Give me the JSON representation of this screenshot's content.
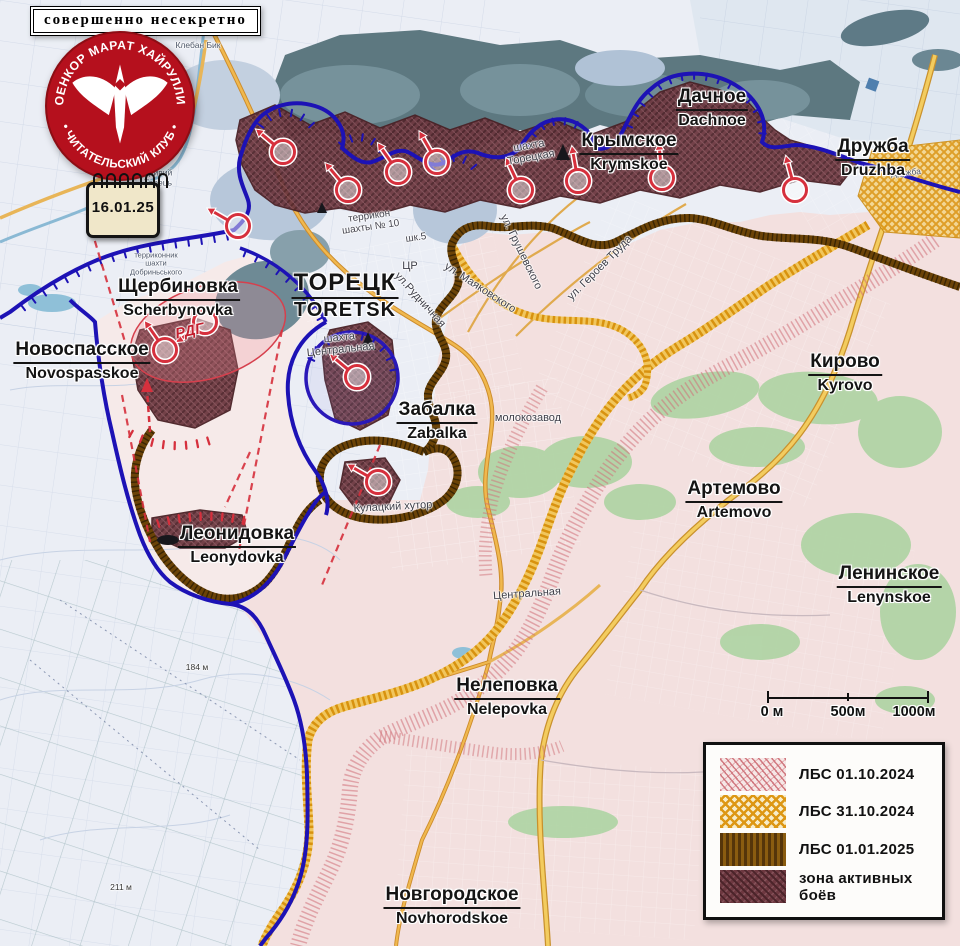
{
  "banner": {
    "text": "совершенно несекретно"
  },
  "logo": {
    "arc_top": "ВОЕНКОР МАРАТ ХАЙРУЛЛИН",
    "arc_bottom": "• ЧИТАТЕЛЬСКИЙ КЛУБ •"
  },
  "calendar": {
    "date": "16.01.25"
  },
  "places": [
    {
      "id": "shcherbynovka",
      "ru": "Щербиновка",
      "en": "Scherbynovka"
    },
    {
      "id": "novospasskoe",
      "ru": "Новоспасское",
      "en": "Novospasskoe"
    },
    {
      "id": "toretsk",
      "ru": "ТОРЕЦК",
      "en": "TORETSK"
    },
    {
      "id": "dachnoe",
      "ru": "Дачное",
      "en": "Dachnoe"
    },
    {
      "id": "krymskoe",
      "ru": "Крымское",
      "en": "Krymskoe"
    },
    {
      "id": "druzhba",
      "ru": "Дружба",
      "en": "Druzhba"
    },
    {
      "id": "zabalka",
      "ru": "Забалка",
      "en": "Zabalka"
    },
    {
      "id": "kyrovo",
      "ru": "Кирово",
      "en": "Kyrovo"
    },
    {
      "id": "artemovo",
      "ru": "Артемово",
      "en": "Artemovo"
    },
    {
      "id": "lenynskoe",
      "ru": "Ленинское",
      "en": "Lenynskoe"
    },
    {
      "id": "leonydovka",
      "ru": "Леонидовка",
      "en": "Leonydovka"
    },
    {
      "id": "nelepovka",
      "ru": "Нелеповка",
      "en": "Nelepovka"
    },
    {
      "id": "novhorodskoe",
      "ru": "Новгородское",
      "en": "Novhorodskoe"
    }
  ],
  "map_labels": [
    {
      "id": "shakhta-toretskaya",
      "text": "шахта\nТорецкая"
    },
    {
      "id": "terrikon-shakhty-10",
      "text": "террикон\nшахты № 10"
    },
    {
      "id": "shk-5",
      "text": "шк.5"
    },
    {
      "id": "tsr",
      "text": "ЦР"
    },
    {
      "id": "ul-rudnichnaya",
      "text": "ул.Рудничная"
    },
    {
      "id": "ul-mayakovskogo",
      "text": "ул. Маяковского"
    },
    {
      "id": "ul-grushevskogo",
      "text": "ул. Грушевского"
    },
    {
      "id": "ul-geroev-truda",
      "text": "ул. Героев Труда"
    },
    {
      "id": "molokozavod",
      "text": "молокозавод"
    },
    {
      "id": "tsentralnaya-street",
      "text": "Центральная"
    },
    {
      "id": "shakhta-tsentralnaya",
      "text": "шахта\nЦентральная"
    },
    {
      "id": "kulatsky-khutor",
      "text": "Кулацкий хутор"
    },
    {
      "id": "rdg",
      "text": "РДГ"
    },
    {
      "id": "kryvyi-torets",
      "text": "Кривий\nТорець"
    },
    {
      "id": "kleban-byk",
      "text": "Клебан Бик"
    },
    {
      "id": "terrikonnik",
      "text": "терриконник\nшахти\nДобриньського"
    },
    {
      "id": "druzhba-small",
      "text": "Дружба"
    },
    {
      "id": "elev-184",
      "text": "184 м"
    },
    {
      "id": "elev-211",
      "text": "211 м"
    }
  ],
  "legend": {
    "items": [
      {
        "label": "ЛБС 01.10.2024",
        "swatch": "pink-hatch"
      },
      {
        "label": "ЛБС 31.10.2024",
        "swatch": "orange-cross"
      },
      {
        "label": "ЛБС 01.01.2025",
        "swatch": "brown-stripes"
      },
      {
        "label": "зона активных боёв",
        "swatch": "maroon-hatch"
      }
    ]
  },
  "scale": {
    "ticks": [
      "0 м",
      "500м",
      "1000м"
    ]
  },
  "colors": {
    "front_line_blue": "#1d12b5",
    "assault_red": "#d6303d",
    "lbs_01_10_2024": "#cf7078",
    "lbs_31_10_2024": "#dd9714",
    "lbs_01_01_2025": "#6b4307",
    "active_battle_zone": "#6d3840",
    "logo_red": "#b5101d"
  }
}
